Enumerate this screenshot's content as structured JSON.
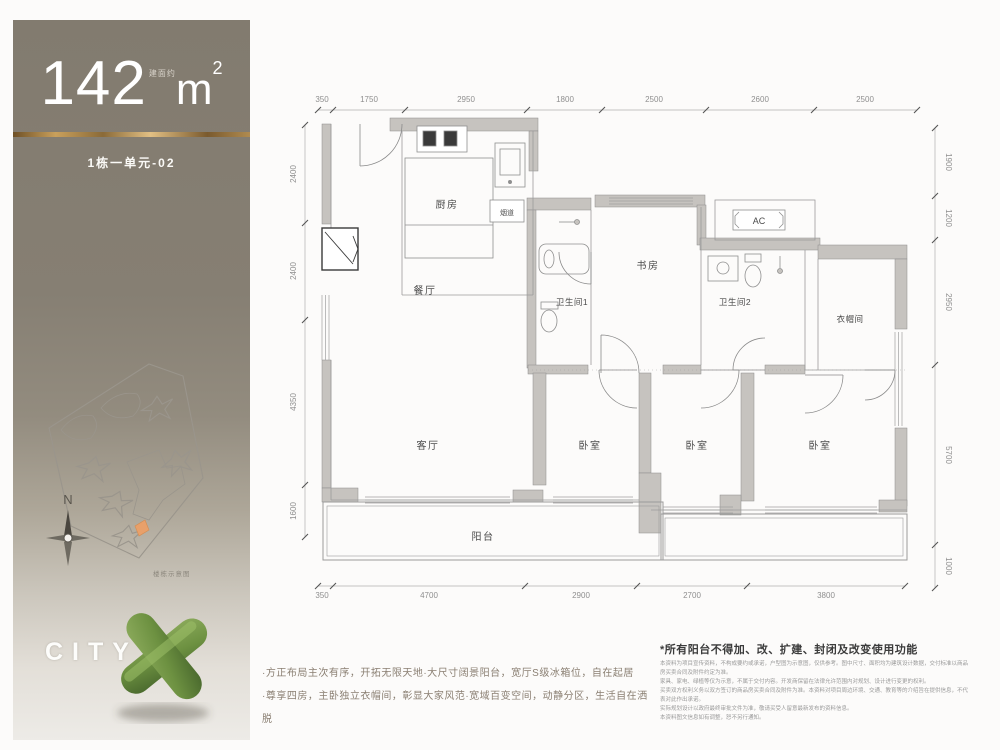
{
  "panel": {
    "area_prefix": "建面约",
    "area_number": "142",
    "area_unit": "m",
    "area_exponent": "2",
    "unit_label": "1栋一单元-02",
    "compass": "N",
    "site_caption": "楼栋示意图",
    "brand": "CITY X"
  },
  "plan": {
    "rooms": {
      "kitchen": "厨房",
      "dining": "餐厅",
      "bath1": "卫生间1",
      "study": "书房",
      "bath2": "卫生间2",
      "closet": "衣帽间",
      "living": "客厅",
      "bedroom1": "卧室",
      "bedroom2": "卧室",
      "bedroom3": "卧室",
      "balcony": "阳台",
      "ac": "AC",
      "flue": "烟道"
    },
    "dims_top": [
      "350",
      "1750",
      "2950",
      "1800",
      "2500",
      "2600",
      "2500"
    ],
    "dims_left": [
      "2400",
      "2400",
      "4350",
      "1600"
    ],
    "dims_right": [
      "1900",
      "1200",
      "2950",
      "5700",
      "1000"
    ],
    "dims_bottom": [
      "350",
      "4700",
      "2900",
      "2700",
      "3800"
    ]
  },
  "footer": {
    "bullet1": "·方正布局主次有序，开拓无限天地·大尺寸阔景阳台，宽厅S级冰箱位，自在起居",
    "bullet2": "·尊享四房，主卧独立衣帽间，彰显大家风范·宽域百变空间，动静分区，生活自在洒脱",
    "disclaimer_title": "*所有阳台不得加、改、扩建、封闭及改变使用功能",
    "disclaimer_body": "本资料为项目宣传资料，不构成要约或承诺，户型图为示意图，仅供参考。图中尺寸、面积均为建筑设计数据，交付标准以商品房买卖合同及附件约定为准。\n家具、家电、绿植等仅为示意，不属于交付内容。开发商保留在法律允许范围内对规划、设计进行变更的权利。\n买卖双方权利义务以双方签订的商品房买卖合同及附件为准。本资料对项目周边环境、交通、教育等的介绍旨在提供信息，不代表对此作出承诺。\n实际规划设计以政府最终审批文件为准，敬请买受人留意最新发布的资料信息。\n本资料图文信息如有调整，恕不另行通知。"
  },
  "colors": {
    "panel_top": "#857e71",
    "gold": "#c9a05c",
    "wall_fill": "#c6c3bf",
    "accent_green": "#6f9445",
    "highlight_orange": "#e8a06a"
  }
}
